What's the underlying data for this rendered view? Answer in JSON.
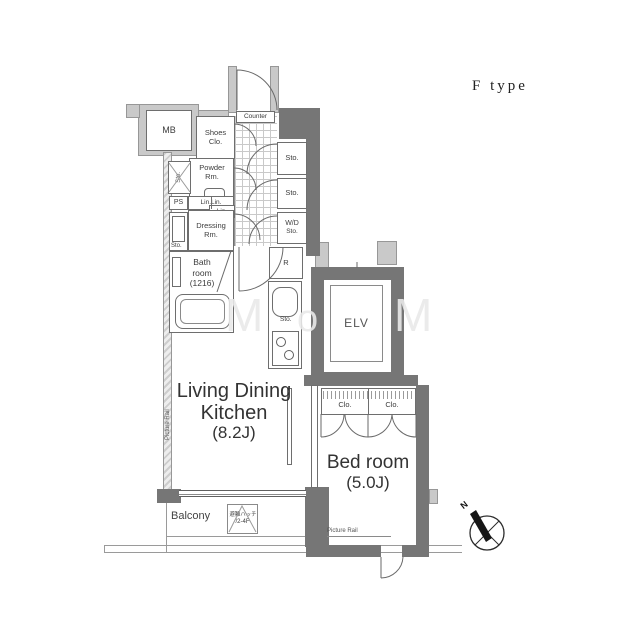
{
  "header": {
    "type_label": "F type"
  },
  "labels": {
    "mb": "MB",
    "shoes1": "Shoes",
    "shoes2": "Clo.",
    "counter": "Counter",
    "sto_a": "Sto.",
    "sto_b": "Sto.",
    "wd1": "W/D",
    "wd2": "Sto.",
    "powder1": "Powder",
    "powder2": "Rm.",
    "powder_sto": "Sto.",
    "ps": "PS",
    "linlin": "Lin.Lin.",
    "lin": "Lin.",
    "dress1": "Dressing",
    "dress2": "Rm.",
    "dress_sto": "Sto.",
    "bath1": "Bath",
    "bath2": "room",
    "bath3": "(1216)",
    "fridge": "R",
    "kitchen_sto": "Sto.",
    "elv": "ELV",
    "ldk1": "Living Dining",
    "ldk2": "Kitchen",
    "ldk3": "(8.2J)",
    "bed1": "Bed room",
    "bed2": "(5.0J)",
    "clo1": "Clo.",
    "clo2": "Clo.",
    "balcony": "Balcony",
    "hatch1": "避難ハッチ",
    "hatch2": "/2-4F",
    "prail_left": "Picture Rail",
    "prail_bottom": "Picture Rail",
    "compass_n": "N",
    "watermark": [
      "M",
      "o",
      "M"
    ]
  },
  "colors": {
    "wall_light": "#c9c9c9",
    "wall_dark": "#767676",
    "line": "#5f5f5f",
    "text": "#3c3c3c"
  }
}
